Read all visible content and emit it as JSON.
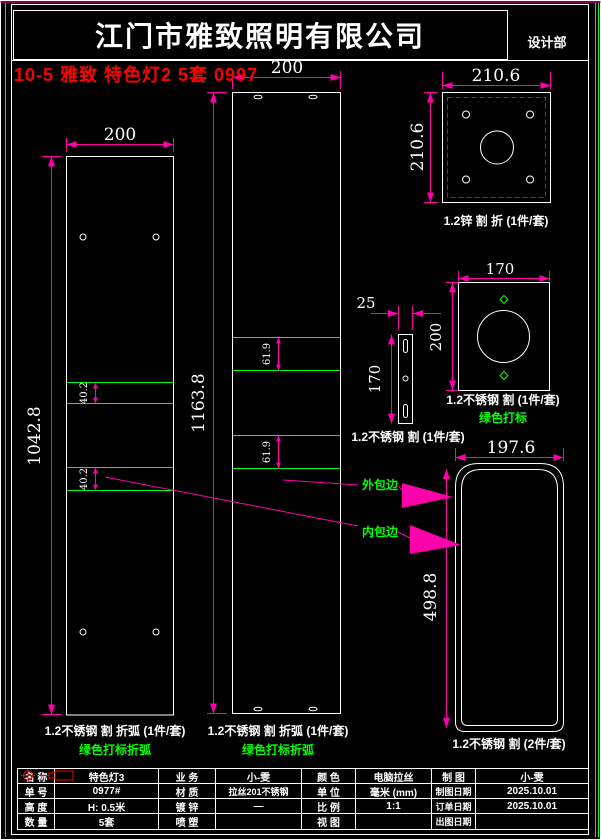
{
  "header": {
    "company": "江门市雅致照明有限公司",
    "dept": "设计部",
    "note": "10-5 雅致 特色灯2 5套 0997"
  },
  "colors": {
    "background": "#000000",
    "line_white": "#ffffff",
    "dim_magenta": "#ff00aa",
    "mark_green": "#00ff00",
    "note_red": "#ff0000"
  },
  "dims": {
    "left_panel_width": "200",
    "left_panel_height": "1042.8",
    "left_panel_band": "40.2",
    "mid_panel_width": "200",
    "mid_panel_height": "1163.8",
    "mid_panel_band": "61.9",
    "zinc_plate_width": "210.6",
    "zinc_plate_height": "210.6",
    "strip_width": "25",
    "strip_height": "170",
    "face_plate_width": "170",
    "face_plate_height": "200",
    "wrap_panel_width": "197.6",
    "wrap_panel_height": "498.8"
  },
  "labels": {
    "left_panel": "1.2不锈钢 割 折弧 (1件/套)",
    "left_panel_sub": "绿色打标折弧",
    "mid_panel": "1.2不锈钢 割 折弧 (1件/套)",
    "mid_panel_sub": "绿色打标折弧",
    "zinc_plate": "1.2锌 割 折 (1件/套)",
    "strip": "1.2不锈钢 割 (1件/套)",
    "face_plate": "1.2不锈钢 割 (1件/套)",
    "face_plate_sub": "绿色打标",
    "wrap_panel": "1.2不锈钢 割 (2件/套)",
    "callout_outer": "外包边",
    "callout_inner": "内包边"
  },
  "icons": {
    "view_symbol": "first-angle-projection-symbol"
  },
  "table": {
    "rows": [
      {
        "c0": "名 称",
        "c1": "特色灯3",
        "c2": "业 务",
        "c3": "小-雯",
        "c4": "颜 色",
        "c5": "电脑拉丝",
        "c6": "制 图",
        "c7": "小-雯"
      },
      {
        "c0": "单 号",
        "c1": "0977#",
        "c2": "材 质",
        "c3": "拉丝201不锈钢",
        "c4": "单 位",
        "c5": "毫米 (mm)",
        "c6": "制图日期",
        "c7": "2025.10.01"
      },
      {
        "c0": "高 度",
        "c1": "H: 0.5米",
        "c2": "镀 锌",
        "c3": "—",
        "c4": "比 例",
        "c5": "1:1",
        "c6": "订单日期",
        "c7": "2025.10.01"
      },
      {
        "c0": "数 量",
        "c1": "5套",
        "c2": "喷 塑",
        "c3": "",
        "c4": "视 图",
        "c5": "",
        "c6": "出图日期",
        "c7": ""
      }
    ]
  }
}
